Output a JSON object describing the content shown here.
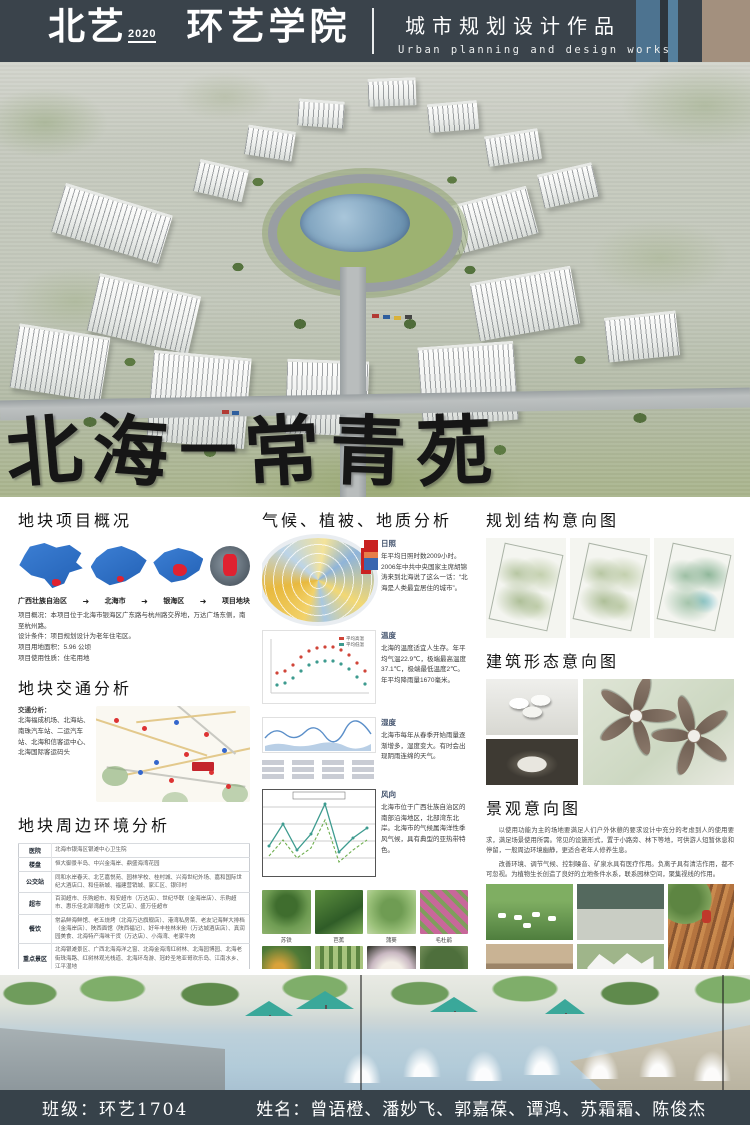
{
  "header": {
    "logo_primary": "北艺",
    "logo_year": "2020",
    "logo_secondary": "环艺学院",
    "title_cn": "城市规划设计作品",
    "title_en": "Urban planning and design works",
    "colors": {
      "bg": "#3a434b",
      "accent_blue": "#4d7390",
      "accent_tan": "#a3907e"
    }
  },
  "hero": {
    "title_chars": [
      "北",
      "海",
      "—",
      "常",
      "青",
      "苑"
    ]
  },
  "site_overview": {
    "title": "地块项目概况",
    "map_steps": [
      "广西壮族自治区",
      "北海市",
      "银海区",
      "项目地块"
    ],
    "arrow": "➜",
    "lines": [
      "项目概况：本项目位于北海市银海区广东路与杭州路交界地，万达广场东侧，南至杭州路。",
      "设计条件：项目规划设计为老年住宅区。",
      "项目用地面积：5.96 公顷",
      "项目使用性质：住宅用地"
    ]
  },
  "traffic": {
    "title": "地块交通分析",
    "heading": "交通分析：",
    "text": "北海福成机场、北海站、南珠汽车站、二运汽车站、北海和信客运中心、北海国际客运码头"
  },
  "surroundings": {
    "title": "地块周边环境分析",
    "table": [
      {
        "label": "医院",
        "content": "北海市银海区银滩中心卫生院"
      },
      {
        "label": "楼盘",
        "content": "恒大御景半岛、中兴金海岸、鼎盛海湾花园"
      },
      {
        "label": "公交站",
        "content": "同和水岸春天、北艺嘉悦苑、园林学校、桂村城、兴海世纪外场、嘉和国际世纪大酒店口、和佳新城、福建营销城、家汇区、银印村"
      },
      {
        "label": "超市",
        "content": "百润超市、乐购超市、和安超市（万达店）、世纪华联（金海岸店）、乐购超市、惠乐佳北部湾超市（文艺店）、盛万佳超市"
      },
      {
        "label": "餐饮",
        "content": "常品鲜海鲜馆、老五烧烤（北海万达旗舰店）、港湾私房菜、老友记海鲜大排档（金海岸店）、陕西面馆（陕西福记）、好年丰桂林米粉（万达城酒店店）、真润园美食、北海特产海味干货（万达店）、小海湾、老家牛肉"
      },
      {
        "label": "重点景区",
        "content": "北海银滩景区、广西北海海洋之窗、北海金海湾红树林、北海园博园、北海老街珠海路、红树林观光栈道、北海环岛游、冠岭圣地亚哥欢乐岛、江南水乡、江平湿地"
      },
      {
        "label": "学校",
        "content": "北海市机关幼儿园、先锋巧稚雅幼儿园、民族幼儿园、北海小学、中央民族大学附中北海国际学校、银海区第二小学、北海市华侨中学、外国语实验学校、银海区第一小学、银海区沙田中心幼儿园、北海艺术设计学院"
      }
    ],
    "zones": [
      {
        "label": "商业娱乐区",
        "captions": [
          "万达广场",
          "银滩大型乐园"
        ]
      },
      {
        "label": "新型建材批发区",
        "captions": [
          "兴发建材商城",
          "桂海建材批发中心"
        ]
      },
      {
        "label": "幼儿园区",
        "captions": [
          "乐启迪景悦幼儿园",
          ""
        ]
      },
      {
        "label": "楼盘区",
        "captions": [
          "恒大御景半岛",
          "逸海湾花园"
        ]
      }
    ]
  },
  "climate": {
    "title": "气候、植被、地质分析",
    "blocks": [
      {
        "heading": "日照",
        "text": "年平均日照时数2009小时。2006年中共中央国家主席胡锦涛来到北海说了这么一话：“北海是人类最宜居住的城市”。"
      },
      {
        "heading": "温度",
        "text": "北海的温度适宜人生存。年平均气温22.9℃，极端最高温度37.1℃，极端最低温度2℃。年平均降雨量1670毫米。"
      },
      {
        "heading": "湿度",
        "text": "北海市每年从春季开始雨量逐渐增多，湿度变大。有时会出现阴雨连绵的天气。"
      },
      {
        "heading": "风向",
        "text": "北海市位于广西壮族自治区的南部沿海地区，北部湾东北岸。北海市的气候属海洋性季风气候，具有典型的亚热带特色。"
      }
    ],
    "temp_legend": [
      "平均高温",
      "平均低温"
    ],
    "plants": [
      "苏铁",
      "芭蕉",
      "蒲葵",
      "毛杜鹃",
      "三角梅",
      "佛肚竹",
      "白玉兰",
      "高山榕"
    ],
    "geology": {
      "heading1": "地貌概况：",
      "text1": "北海市位于广西南部沿海地区，濒临北部湾，东北部为丘状丘陵，海拔一般100～200m，最高为22.8m；北海市除广泛分布第四系外，其余出露的地层有志留系、泥盆系、石炭系、白垩系和第三系等，岩性主要为第四系和第三系的松散土体，岩性主要为松散状土、粘土、砂砾等，其次为砂岩、泥岩、页岩、碳酸盐岩和花岗岩、火山角砾岩和玄武岩等。",
      "heading2": "地质灾害时间分布段：",
      "text2": "崩塌、滑坡一般发生在每年的7～8月份，尤其是台风伴随强降雨的情况下，发生崩塌、滑坡的可能性最大。岩溶地面塌陷除人为因素外，主要发生的时间段在枯水期12月至翌年的1、2月份。"
    }
  },
  "intentions": {
    "planning_title": "规划结构意向图",
    "building_title": "建筑形态意向图",
    "landscape_title": "景观意向图",
    "landscape_p1": "以使用功能为主的场地要满足人们户外休憩的要求设计中充分的考虑到人的使用要求，满足场景使用所需。常见的设施形式，置于小路旁、林下等地，可供游人短暂休息和停留，一般周边环境幽静，更适合老年人修养生息。",
    "landscape_p2": "改善环境、调节气候、控制噪音、矿泉水具有医疗作用。负离子具有清洁作用，都不可忽视。为植物生长创造了良好的立地条件水系，联系园林空间，聚集视线的作用。"
  },
  "footer": {
    "class_label": "班级：环艺1704",
    "names_label": "姓名：曾语橙、潘妙飞、郭嘉葆、谭鸿、苏霜霜、陈俊杰"
  }
}
